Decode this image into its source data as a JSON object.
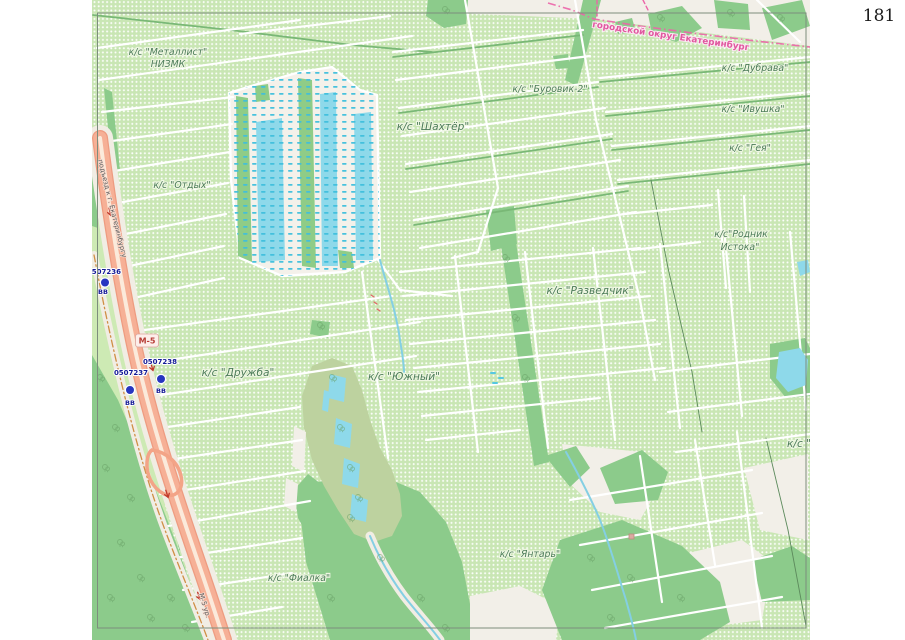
{
  "page": {
    "number": "181"
  },
  "boundary": {
    "label": "городской округ Екатеринбург"
  },
  "road": {
    "shield": "М-5",
    "name": "подъезд к г. Екатеринбургу",
    "name_bottom": "М-5 ур."
  },
  "labels": {
    "metallist": "к/с \"Металлист\"",
    "nizmk": "НИЗМК",
    "otdyh": "к/с \"Отдых\"",
    "shahter": "к/с \"Шахтёр\"",
    "burovik": "к/с \"Буровик-2\"",
    "dubrava": "к/с \"Дубрава\"",
    "ivushka": "к/с \"Ивушка\"",
    "geya": "к/с \"Гея\"",
    "rodnik1": "к/с\"Родник",
    "rodnik2": "Истока\"",
    "razvedchik": "к/с \"Разведчик\"",
    "druzhba": "к/с \"Дружба\"",
    "yuzhny": "к/с \"Южный\"",
    "fialka": "к/с \"Фиалка\"",
    "yantar": "к/с \"Янтарь\"",
    "d_cut": "к/с \"Д"
  },
  "markers": [
    {
      "id": "0507236",
      "tag": "ВВ"
    },
    {
      "id": "0507237",
      "tag": "ВВ"
    },
    {
      "id": "0507238",
      "tag": "ВВ"
    }
  ],
  "colors": {
    "allotment_green": "#c9e6b4",
    "forest_green": "#8ccb8b",
    "wetland_olive": "#bdd29f",
    "water_cyan": "#8ed9ea",
    "trunk_road_orange": "#f3a487",
    "boundary_pink": "#ec64a8",
    "marker_blue": "#2736c0",
    "label_green": "#4c7c58",
    "page_bg_beige": "#f2efe8"
  }
}
